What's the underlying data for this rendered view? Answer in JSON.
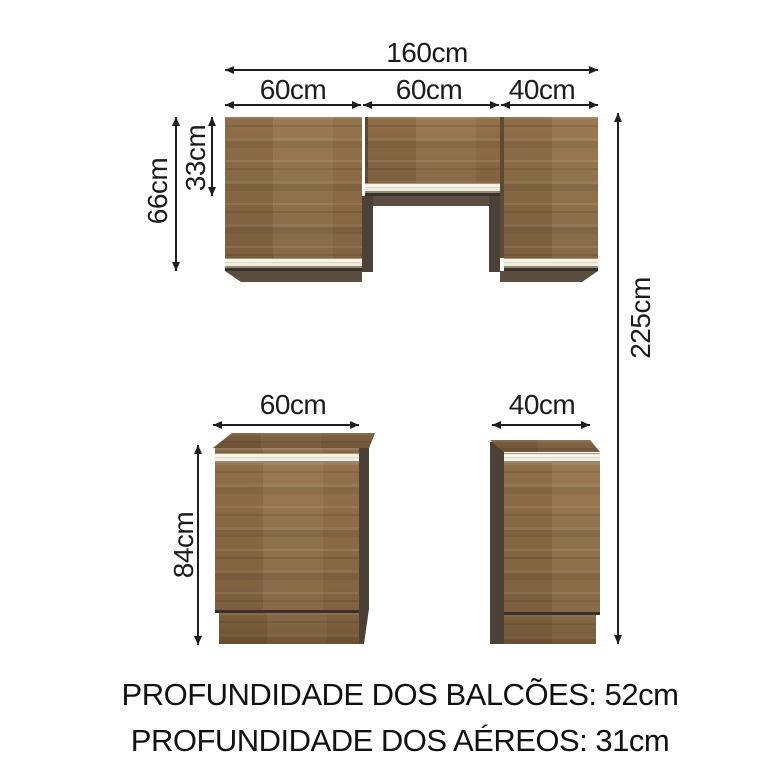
{
  "dims": {
    "total_width": "160cm",
    "seg1": "60cm",
    "seg2": "60cm",
    "seg3": "40cm",
    "upper_total_height": "66cm",
    "upper_top_door_height": "33cm",
    "overall_height": "225cm",
    "base_left_width": "60cm",
    "base_right_width": "40cm",
    "base_height": "84cm"
  },
  "notes": {
    "line1": "PROFUNDIDADE DOS BALCÕES: 52cm",
    "line2": "PROFUNDIDADE DOS AÉREOS: 31cm"
  },
  "colors": {
    "wood": "#8c6b44",
    "wood_shadow": "#5b4d3f",
    "panel_dark": "#4c4136",
    "handle_strip": "#f0ecdf",
    "ink": "#1e1e1e",
    "background": "#ffffff"
  }
}
